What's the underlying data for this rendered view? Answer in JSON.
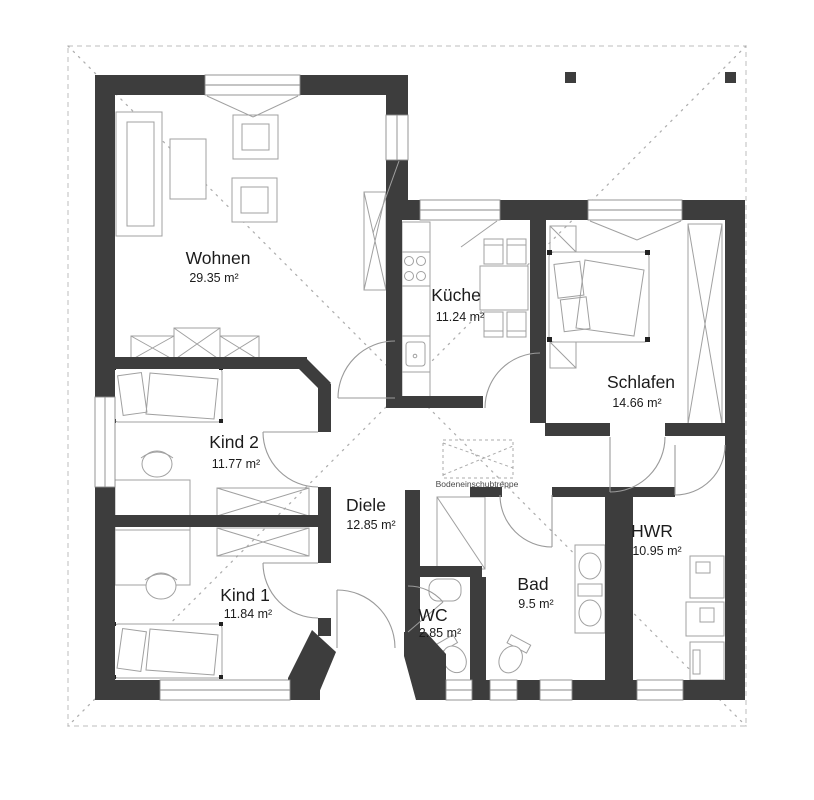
{
  "floor_plan": {
    "annotation": "Bodeneinschubtreppe",
    "rooms": [
      {
        "name": "Wohnen",
        "area": "29.35 m²"
      },
      {
        "name": "Küche",
        "area": "11.24 m²"
      },
      {
        "name": "Schlafen",
        "area": "14.66 m²"
      },
      {
        "name": "Kind 2",
        "area": "11.77 m²"
      },
      {
        "name": "Diele",
        "area": "12.85 m²"
      },
      {
        "name": "Kind 1",
        "area": "11.84 m²"
      },
      {
        "name": "WC",
        "area": "2.85 m²"
      },
      {
        "name": "Bad",
        "area": "9.5 m²"
      },
      {
        "name": "HWR",
        "area": "10.95 m²"
      }
    ],
    "colors": {
      "wall": "#3d3d3d",
      "furniture": "#a0a0a0",
      "roof": "#bdbdbd",
      "text": "#1c1c1c"
    }
  }
}
